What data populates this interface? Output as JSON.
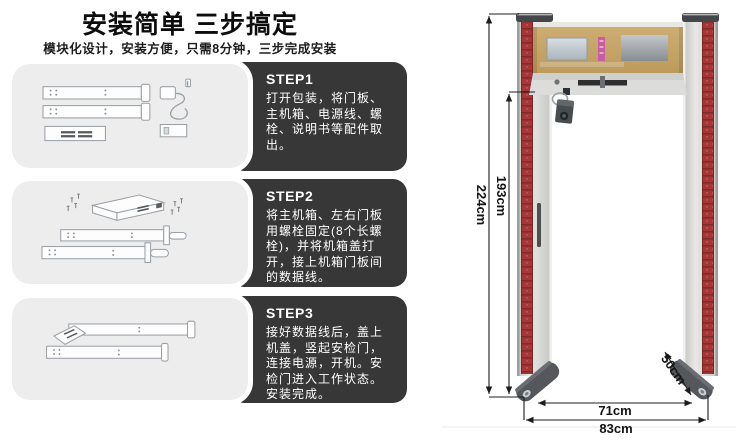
{
  "header": {
    "title": "安装简单 三步搞定",
    "subtitle": "模块化设计，安装方便，只需8分钟，三步完成安装"
  },
  "steps": [
    {
      "label": "STEP1",
      "text": "打开包装，将门板、主机箱、电源线、螺栓、说明书等配件取出。",
      "illustration": "unpacked-door-panels-power-adapter"
    },
    {
      "label": "STEP2",
      "text": "将主机箱、左右门板用螺栓固定(8个长螺栓)，并将机箱盖打开，接上机箱门板间的数据线。",
      "illustration": "main-box-bolted-to-panels"
    },
    {
      "label": "STEP3",
      "text": "接好数据线后，盖上机盖，竖起安检门，连接电源，开机。安检门进入工作状态。安装完成。",
      "illustration": "assembled-gate-lying-flat"
    }
  ],
  "figure": {
    "dimensions": {
      "outer_height": "224cm",
      "inner_height": "193cm",
      "inner_width": "71cm",
      "outer_width": "83cm",
      "base_depth": "50cm"
    }
  },
  "colors": {
    "step_panel": "#373737",
    "illustration_card": "#ededed",
    "head_unit_beige": "#c7a566",
    "led_strip_red": "#a93636",
    "pink_label": "#c95da5",
    "dimension_line": "#1c1c1c"
  }
}
